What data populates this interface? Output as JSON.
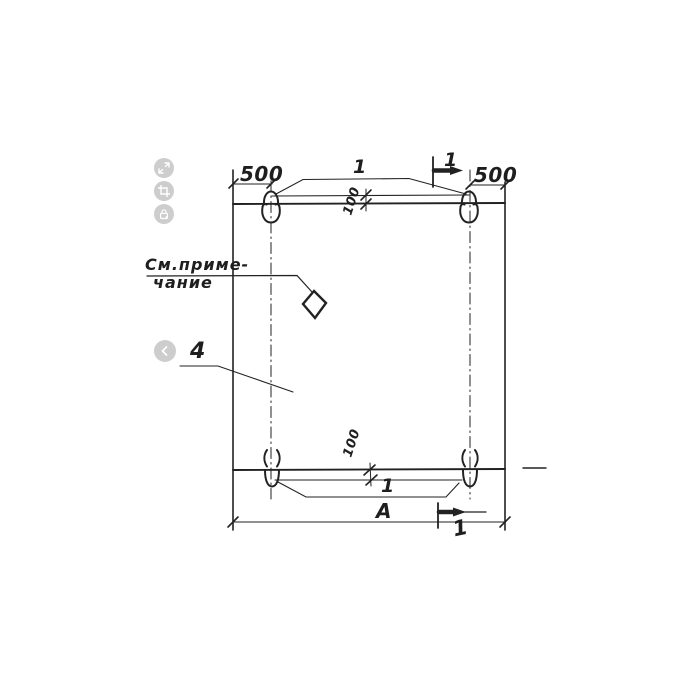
{
  "drawing": {
    "labels": {
      "dim_left_500": "500",
      "dim_right_500": "500",
      "dim_offset_top_100": "100",
      "dim_offset_bottom_100": "100",
      "dim_width_A": "А",
      "callout_top_loops": "1",
      "callout_bottom_loops": "1",
      "section_mark_top": "1",
      "section_mark_bottom": "1",
      "part_number": "4",
      "note_line1": "См.приме-",
      "note_line2": "чание"
    },
    "colors": {
      "line": "#222222",
      "background": "#ffffff",
      "viewer_button": "#c9c9c9",
      "viewer_glyph": "#ffffff"
    }
  },
  "viewer": {
    "icons": [
      "expand-icon",
      "crop-icon",
      "lock-icon",
      "previous-icon"
    ]
  }
}
